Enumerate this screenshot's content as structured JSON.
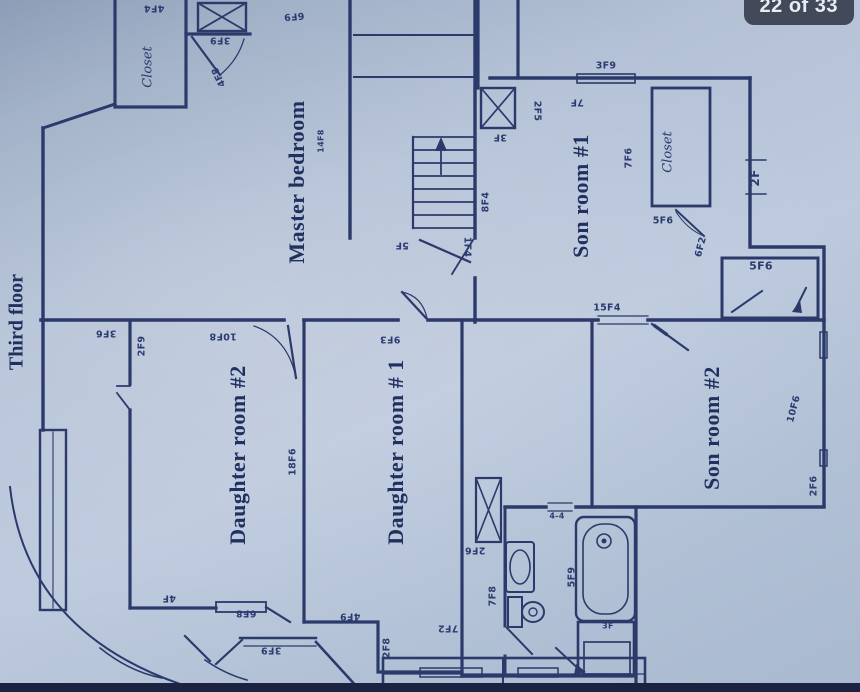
{
  "viewer": {
    "page_badge": "22 of 33"
  },
  "colors": {
    "ink": "#2b3a6a",
    "paper": "#b7c4d8",
    "badge_bg": "#383f4e",
    "badge_text": "#e9ecf2",
    "photo_strip": "#1c2342"
  },
  "plan": {
    "title": "Third floor",
    "room_names": [
      "Master bedroom",
      "Son room #1",
      "Son room #2",
      "Daughter room #2",
      "Daughter room # 1"
    ],
    "labels": [
      {
        "text": "Third floor",
        "x": 17,
        "y": 322,
        "rot": -90,
        "cls": "title"
      },
      {
        "text": "Master bedroom",
        "x": 297,
        "y": 182,
        "rot": -90,
        "cls": "room"
      },
      {
        "text": "Son room #1",
        "x": 581,
        "y": 196,
        "rot": -90,
        "cls": "room"
      },
      {
        "text": "Son room #2",
        "x": 712,
        "y": 428,
        "rot": -90,
        "cls": "room"
      },
      {
        "text": "Daughter room #2",
        "x": 238,
        "y": 455,
        "rot": -90,
        "cls": "room"
      },
      {
        "text": "Daughter room # 1",
        "x": 396,
        "y": 452,
        "rot": -90,
        "cls": "room"
      },
      {
        "text": "Closet",
        "x": 148,
        "y": 67,
        "rot": -90,
        "cls": "closet"
      },
      {
        "text": "Closet",
        "x": 668,
        "y": 152,
        "rot": -90,
        "cls": "closet"
      },
      {
        "text": "4F4",
        "x": 154,
        "y": 8,
        "rot": 180,
        "cls": "dim"
      },
      {
        "text": "6F9",
        "x": 294,
        "y": 16,
        "rot": 175,
        "cls": "dim"
      },
      {
        "text": "3F9",
        "x": 220,
        "y": 40,
        "rot": 180,
        "cls": "dim"
      },
      {
        "text": "4F8",
        "x": 219,
        "y": 77,
        "rot": 245,
        "cls": "dim"
      },
      {
        "text": "14F8",
        "x": 321,
        "y": 141,
        "rot": -90,
        "cls": "dim",
        "size": 8
      },
      {
        "text": "5F",
        "x": 402,
        "y": 245,
        "rot": 180,
        "cls": "dim"
      },
      {
        "text": "1F4",
        "x": 467,
        "y": 247,
        "rot": 90,
        "cls": "dim"
      },
      {
        "text": "8F4",
        "x": 486,
        "y": 202,
        "rot": -90,
        "cls": "dim"
      },
      {
        "text": "3F9",
        "x": 606,
        "y": 66,
        "rot": 0,
        "cls": "dim"
      },
      {
        "text": "7F",
        "x": 577,
        "y": 102,
        "rot": 180,
        "cls": "dim"
      },
      {
        "text": "2F5",
        "x": 537,
        "y": 111,
        "rot": 90,
        "cls": "dim"
      },
      {
        "text": "3F",
        "x": 500,
        "y": 137,
        "rot": 180,
        "cls": "dim"
      },
      {
        "text": "7F6",
        "x": 629,
        "y": 158,
        "rot": -90,
        "cls": "dim"
      },
      {
        "text": "5F6",
        "x": 663,
        "y": 221,
        "rot": 0,
        "cls": "dim"
      },
      {
        "text": "6F2",
        "x": 701,
        "y": 247,
        "rot": -75,
        "cls": "dim"
      },
      {
        "text": "2F",
        "x": 755,
        "y": 178,
        "rot": -90,
        "cls": "dim",
        "size": 12
      },
      {
        "text": "15F4",
        "x": 607,
        "y": 308,
        "rot": 0,
        "cls": "dim"
      },
      {
        "text": "5F6",
        "x": 761,
        "y": 266,
        "rot": 0,
        "cls": "dim",
        "size": 11
      },
      {
        "text": "3F6",
        "x": 106,
        "y": 333,
        "rot": 180,
        "cls": "dim"
      },
      {
        "text": "2F9",
        "x": 142,
        "y": 346,
        "rot": -90,
        "cls": "dim"
      },
      {
        "text": "10F8",
        "x": 223,
        "y": 336,
        "rot": 180,
        "cls": "dim"
      },
      {
        "text": "18F6",
        "x": 293,
        "y": 462,
        "rot": -90,
        "cls": "dim"
      },
      {
        "text": "9F3",
        "x": 390,
        "y": 339,
        "rot": 180,
        "cls": "dim"
      },
      {
        "text": "10F6",
        "x": 794,
        "y": 409,
        "rot": -75,
        "cls": "dim"
      },
      {
        "text": "2F6",
        "x": 814,
        "y": 486,
        "rot": -90,
        "cls": "dim"
      },
      {
        "text": "2F6",
        "x": 475,
        "y": 550,
        "rot": 180,
        "cls": "dim"
      },
      {
        "text": "7F8",
        "x": 493,
        "y": 596,
        "rot": -90,
        "cls": "dim"
      },
      {
        "text": "5F9",
        "x": 572,
        "y": 577,
        "rot": -90,
        "cls": "dim"
      },
      {
        "text": "4-4",
        "x": 557,
        "y": 516,
        "rot": 0,
        "cls": "dim",
        "size": 8
      },
      {
        "text": "3F",
        "x": 608,
        "y": 626,
        "rot": 0,
        "cls": "dim",
        "size": 8
      },
      {
        "text": "4F",
        "x": 169,
        "y": 598,
        "rot": 180,
        "cls": "dim"
      },
      {
        "text": "6F8",
        "x": 246,
        "y": 613,
        "rot": 180,
        "cls": "dim"
      },
      {
        "text": "3F9",
        "x": 271,
        "y": 650,
        "rot": 180,
        "cls": "dim"
      },
      {
        "text": "4F9",
        "x": 350,
        "y": 616,
        "rot": 180,
        "cls": "dim"
      },
      {
        "text": "2F8",
        "x": 387,
        "y": 648,
        "rot": -90,
        "cls": "dim"
      },
      {
        "text": "7F2",
        "x": 448,
        "y": 628,
        "rot": 180,
        "cls": "dim"
      }
    ]
  }
}
